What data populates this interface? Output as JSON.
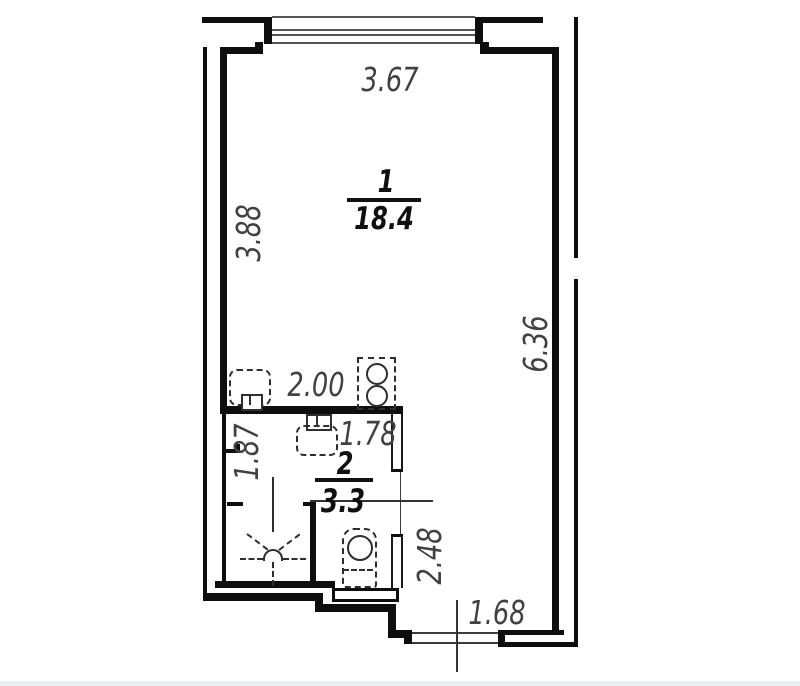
{
  "plan_title": "studio apartment floor plan",
  "rooms": [
    {
      "number": "1",
      "area": "18.4"
    },
    {
      "number": "2",
      "area": "3.3"
    }
  ],
  "dimensions": {
    "top_width": "3.67",
    "left_height": "3.88",
    "right_height": "6.36",
    "bath_outer_width": "2.00",
    "bath_inner_width": "1.78",
    "bath_left_height": "1.87",
    "hall_height": "2.48",
    "entry_width": "1.68"
  },
  "fixtures": {
    "kitchen_sink": "sink-symbol",
    "stove": "two-burner-stove-symbol",
    "washbasin": "washbasin-symbol",
    "toilet": "toilet-symbol",
    "shower": "shower-drain-symbol",
    "window": "triple-line-window-symbol"
  },
  "colors": {
    "wall": "#0e0e0e",
    "thin_line": "#3c3c3c",
    "fixture_line": "#2e2e2e",
    "dimension_text": "#414141",
    "label_text": "#101010",
    "background": "#ffffff"
  }
}
